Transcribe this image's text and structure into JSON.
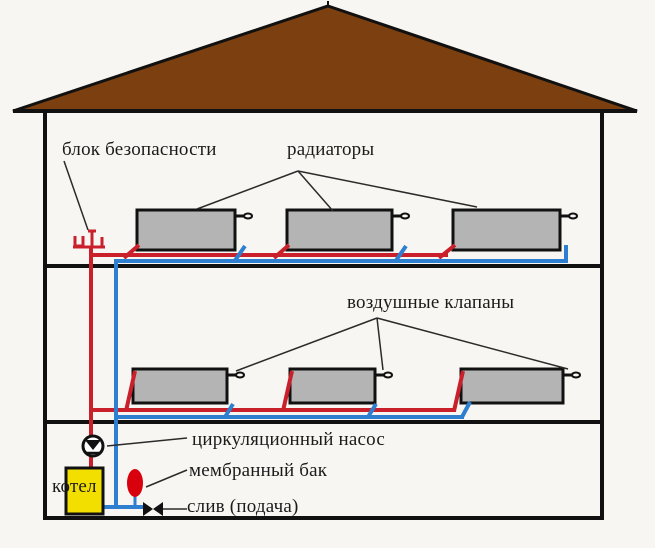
{
  "labels": {
    "safety_block": "блок безопасности",
    "radiators": "радиаторы",
    "air_valves": "воздушные клапаны",
    "circulation_pump": "циркуляционный насос",
    "membrane_tank": "мембранный бак",
    "drain_supply": "слив (подача)",
    "boiler": "котел"
  },
  "colors": {
    "background": "#f7f6f2",
    "roof": "#7c3f10",
    "radiator": "#b4b4b4",
    "pipe_hot": "#c9202c",
    "pipe_cold": "#2e7fd0",
    "boiler": "#f2df00",
    "tank": "#d9000d",
    "line": "#111111"
  },
  "icons": {
    "safety-block-icon": "red manifold trident on hot riser",
    "circulation-pump-icon": "circle with down triangle",
    "membrane-tank-icon": "red vertical ellipse",
    "drain-valve-icon": "black bowtie valve",
    "air-valve-icon": "stub with small loop on radiator"
  },
  "structure": {
    "floors": 2,
    "radiators_top_floor": 3,
    "radiators_lower_floor": 3
  }
}
